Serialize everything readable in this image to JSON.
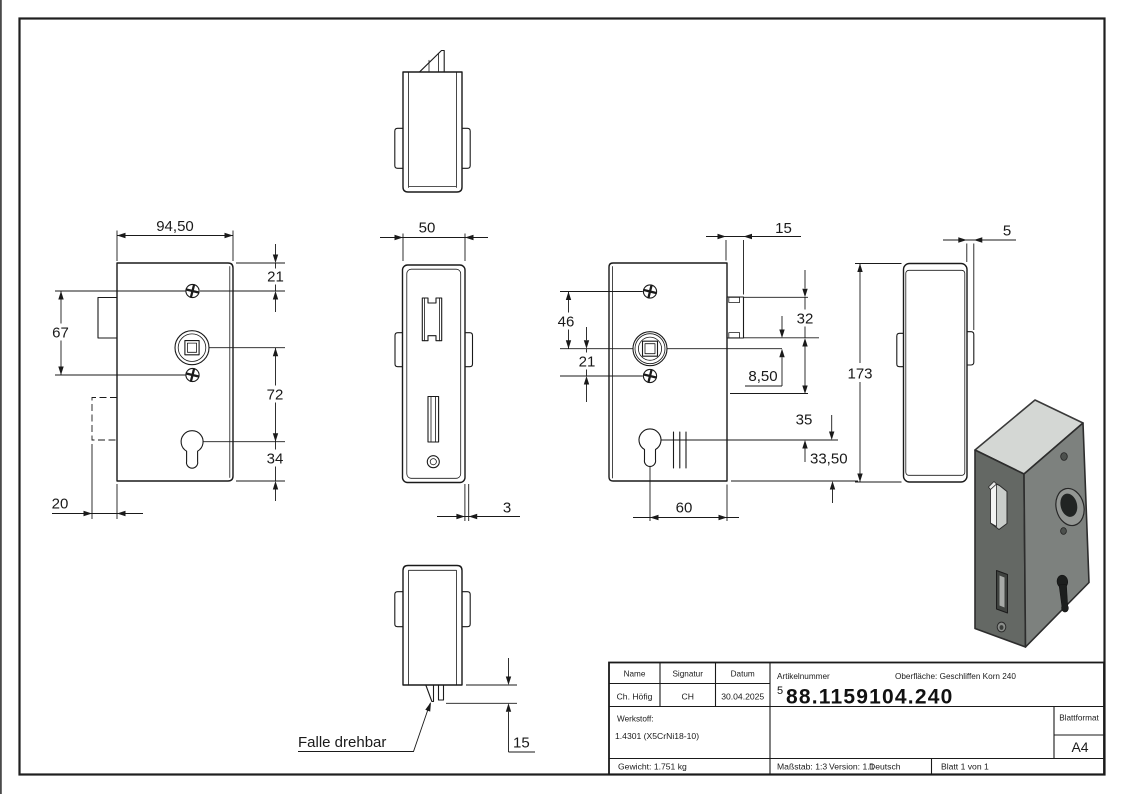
{
  "dims": {
    "front_width": "94,50",
    "front_screw_top": "21",
    "front_screw_span": "67",
    "front_spindle_to_key": "72",
    "front_key_bottom": "34",
    "front_backbox": "20",
    "face_width": "50",
    "face_thickness": "3",
    "latch_protrusion": "15",
    "back_latch_width": "15",
    "back_screw_spindle": "46",
    "back_spindle_screw": "21",
    "back_latch_len": "32",
    "back_offset": "8,50",
    "back_slot": "35",
    "back_key": "33,50",
    "back_key_backset": "60",
    "side_height": "173",
    "side_tab": "5"
  },
  "note": {
    "latch": "Falle drehbar"
  },
  "title_block": {
    "name_label": "Name",
    "signatur_label": "Signatur",
    "datum_label": "Datum",
    "name_value": "Ch. Höfig",
    "signatur_value": "CH",
    "datum_value": "30.04.2025",
    "artikelnummer_label": "Artikelnummer",
    "article_sup": "5",
    "article_number": "88.1159104.240",
    "oberflaeche": "Oberfläche:  Geschliffen Korn 240",
    "werkstoff_label": "Werkstoff:",
    "werkstoff_value": "1.4301 (X5CrNi18-10)",
    "blattformat_label": "Blattformat",
    "blattformat_value": "A4",
    "gewicht": "Gewicht: 1.751 kg",
    "massstab": "Maßstab: 1:3",
    "version": "Version: 1.1",
    "sprache": "Deutsch",
    "blatt": "Blatt 1 von 1"
  },
  "colors": {
    "line": "#1a1a1a",
    "iso_top": "#d4d7d4",
    "iso_left": "#646864",
    "iso_right": "#7d817e"
  }
}
